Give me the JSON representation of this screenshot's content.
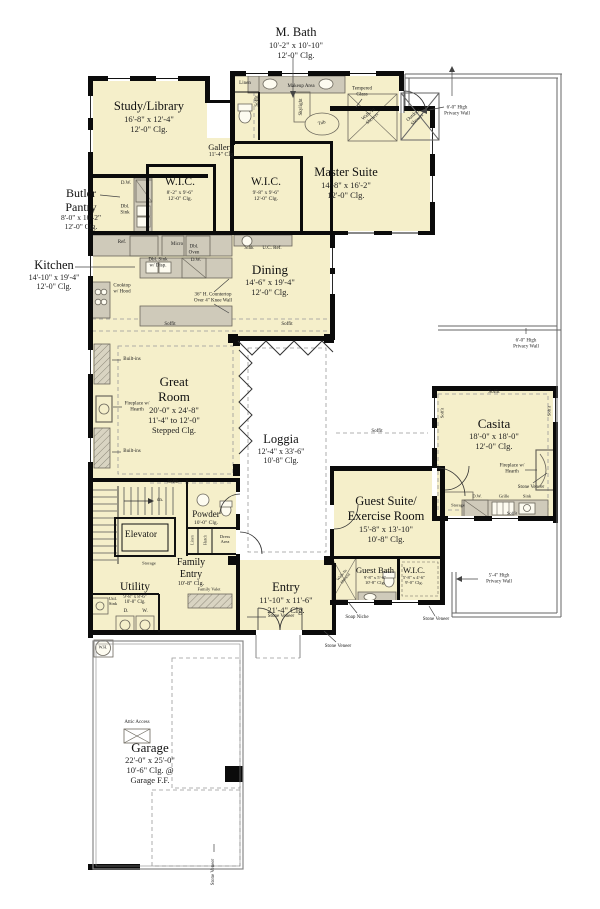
{
  "colors": {
    "room_fill": "#f5efca",
    "wall": "#0b0b0b",
    "counter": "#cfcaba",
    "thin_line": "#666666"
  },
  "rooms": {
    "mbath": {
      "name": "M. Bath",
      "dims": "10'-2\" x 10'-10\"",
      "clg": "12'-0\" Clg."
    },
    "study": {
      "name": "Study/Library",
      "dims": "16'-8\" x 12'-4\"",
      "clg": "12'-0\" Clg."
    },
    "butler": {
      "name": "Butler\nPantry",
      "dims": "8'-0\" x 10'-2\"",
      "clg": "12'-0\" Clg."
    },
    "gallery": {
      "name": "Gallery",
      "clg": "11'-4\" Clg"
    },
    "wic1": {
      "name": "W.I.C.",
      "dims": "8'-2\" x 9'-6\"",
      "clg": "12'-0\" Clg."
    },
    "wic2": {
      "name": "W.I.C.",
      "dims": "9'-8\" x 9'-6\"",
      "clg": "12'-0\" Clg."
    },
    "master": {
      "name": "Master  Suite",
      "dims": "14'-8\" x 16'-2\"",
      "clg": "12'-0\" Clg."
    },
    "kitchen": {
      "name": "Kitchen",
      "dims": "14'-10\" x 19'-4\"",
      "clg": "12'-0\" Clg."
    },
    "dining": {
      "name": "Dining",
      "dims": "14'-6\" x 19'-4\"",
      "clg": "12'-0\" Clg."
    },
    "great": {
      "name": "Great\nRoom",
      "dims": "20'-0\" x 24'-8\"",
      "clg": "11'-4\" to 12'-0\"\nStepped Clg."
    },
    "loggia": {
      "name": "Loggia",
      "dims": "12'-4\" x 33'-6\"",
      "clg": "10'-8\" Clg."
    },
    "casita": {
      "name": "Casita",
      "dims": "18'-0\" x 18'-0\"",
      "clg": "12'-0\" Clg."
    },
    "guest": {
      "name": "Guest Suite/\nExercise Room",
      "dims": "15'-8\" x 13'-10\"",
      "clg": "10'-8\"  Clg."
    },
    "guestbath": {
      "name": "Guest Bath",
      "dims": "9'-8\" x 5'-6\"",
      "clg": "10'-8\" Clg."
    },
    "gwic": {
      "name": "W.I.C.",
      "dims": "5'-8\" x 4'-6\"",
      "clg": "9'-0\" Clg."
    },
    "powder": {
      "name": "Powder",
      "clg": "10'-0\" Clg."
    },
    "elevator": {
      "name": "Elevator"
    },
    "famentry": {
      "name": "Family\nEntry",
      "clg": "10'-8\" Clg."
    },
    "utility": {
      "name": "Utility",
      "dims": "9'-8\" x 8'-6\"",
      "clg": "10'-8\" Clg."
    },
    "entry": {
      "name": "Entry",
      "dims": "11'-10\" x 11'-6\"",
      "clg": "21'-4\" Clg."
    },
    "garage": {
      "name": "Garage",
      "dims": "22'-0\" x 25'-0\"",
      "clg": "10'-6\" Clg. @\nGarage F.F."
    }
  },
  "labels": {
    "linen": "Linen",
    "soffit": "Soffit",
    "makeup_area": "Makeup Area",
    "skylight": "Skylight",
    "tub": "Tub",
    "tempered_glass": "Tempered\nGlass",
    "walkin_shower": "Walk-In\nShower",
    "outdoor_shower": "Outdoor\nShower",
    "dw": "D.W.",
    "dbl_sink": "Dbl.\nSink",
    "ref": "Ref.",
    "micro": "Micro",
    "dbl_oven": "Dbl.\nOven",
    "dbl_sink_disp": "Dbl. Sink\nw/ Disp.",
    "counter_note": "36\" H. Countertop\nOver 4\" Knee Wall",
    "sink": "Sink",
    "uc_ref": "U.C. Ref.",
    "cooktop": "Cooktop\nw/ Hood",
    "built_ins": "Built-ins",
    "fireplace": "Fireplace w/\nHearth",
    "stone_veneer": "Stone Veneer",
    "grille": "Grille",
    "storage": "Storage",
    "soap_niche": "Soap Niche",
    "dress_area": "Dress\nArea",
    "hutch": "Hutch",
    "family_valet": "Family Valet",
    "util_sink": "Util.\nSink",
    "d": "D.",
    "w": "W.",
    "wh": "W.H.",
    "attic_access": "Attic Access",
    "privacy_6": "6'-0\" High\nPrivacy Wall",
    "privacy_54": "5'-4\" High\nPrivacy Wall",
    "stairs_dir": "dn."
  }
}
